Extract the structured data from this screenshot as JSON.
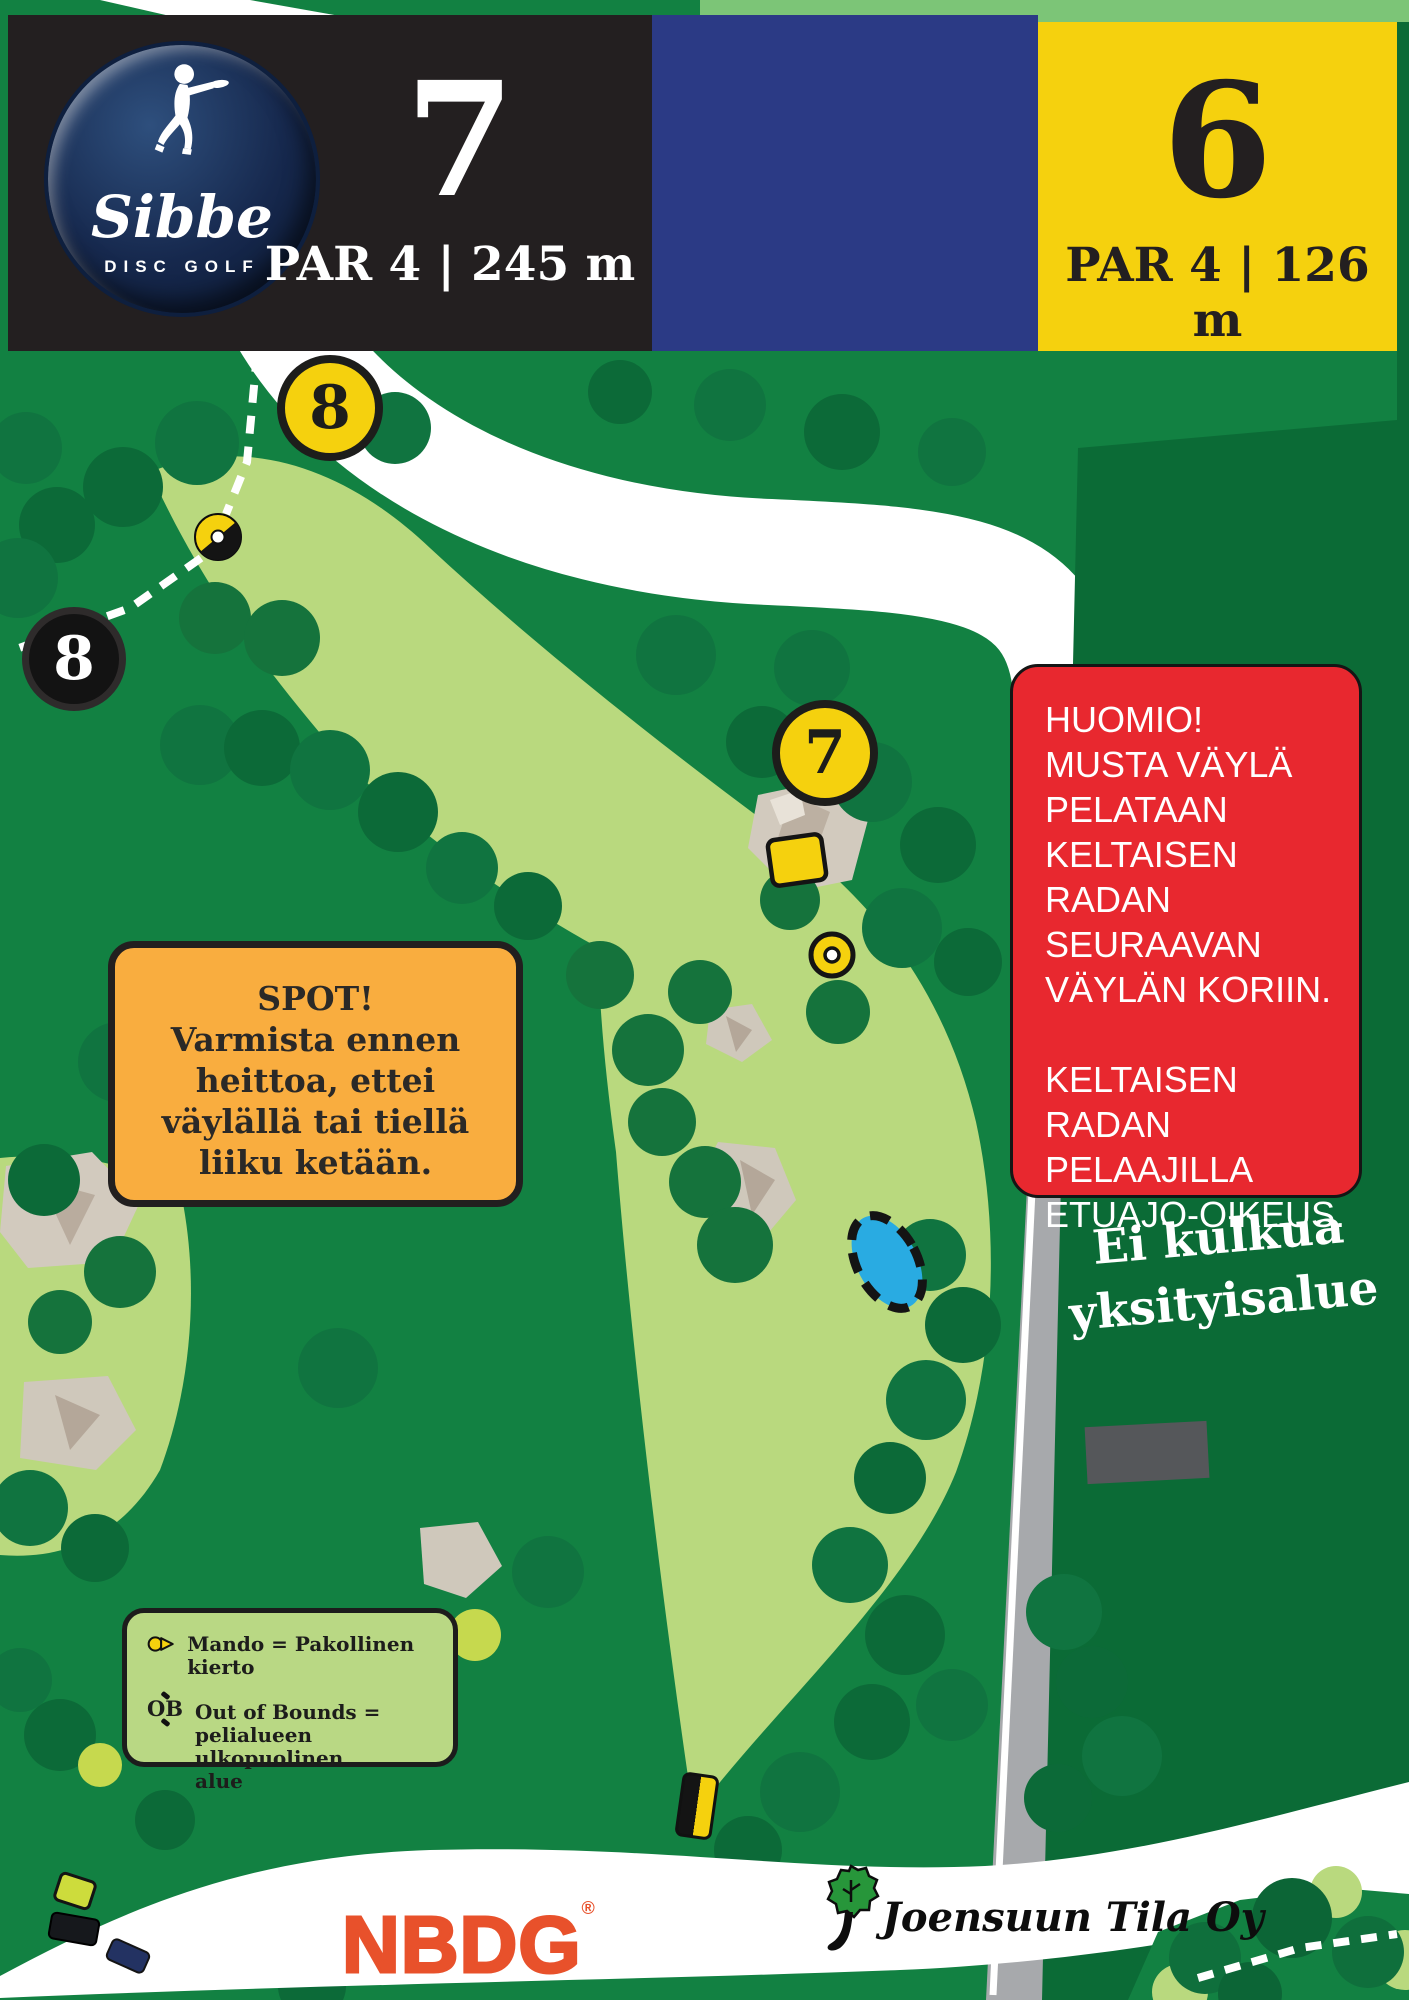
{
  "header": {
    "logo": {
      "brand": "Sibbe",
      "subtitle": "DISC GOLF"
    },
    "hole_black": {
      "number": "7",
      "info": "PAR 4 | 245 m"
    },
    "hole_yellow": {
      "number": "6",
      "info": "PAR 4 | 126 m"
    }
  },
  "map": {
    "markers": {
      "next_tee_yellow_top": "8",
      "next_tee_black": "8",
      "tee_yellow_mid": "7"
    },
    "spot_box": {
      "lines": [
        "SPOT!",
        "Varmista ennen",
        "heittoa, ettei",
        "väylällä tai tiellä",
        "liiku ketään."
      ]
    },
    "huomio_box": {
      "lines": [
        "HUOMIO!",
        "MUSTA VÄYLÄ",
        "PELATAAN",
        "KELTAISEN RADAN",
        "SEURAAVAN",
        "VÄYLÄN KORIIN.",
        "",
        "KELTAISEN RADAN",
        "PELAAJILLA",
        "ETUAJO-OIKEUS."
      ]
    },
    "private_area": {
      "lines": [
        "Ei kulkua",
        "yksityisalue"
      ]
    },
    "legend": {
      "mando": "Mando = Pakollinen kierto",
      "ob_label": "OB",
      "ob_lines": [
        "Out of Bounds =",
        "pelialueen ulkopuolinen",
        "alue"
      ]
    }
  },
  "footer": {
    "nbdg": "NBDG",
    "trademark": "®",
    "partner": "Joensuun Tila Oy"
  },
  "icons": {
    "mando": "yellow-circle-with-arrow",
    "ob": "dashed-boundary-ticks",
    "basket_two_tone": "black-yellow-disc-target",
    "basket_yellow": "yellow-disc-target",
    "tee_pad_black_yellow": "split-rounded-rectangle",
    "thrower": "disc-golfer-silhouette",
    "partner_tree": "green-tree"
  },
  "colors": {
    "grass": "#128142",
    "fairway": "#b9d97e",
    "course-black": "#231f20",
    "course-blue": "#2b3a85",
    "course-yellow": "#f5d10e",
    "notice-red": "#e8282f",
    "notice-orange": "#f9ad3f",
    "legend-green": "#b9d884",
    "private-green": "#0b6b36",
    "pond-blue": "#29abe2",
    "road-gray": "#a7a9ac",
    "nbdg-orange": "#e8512b"
  }
}
